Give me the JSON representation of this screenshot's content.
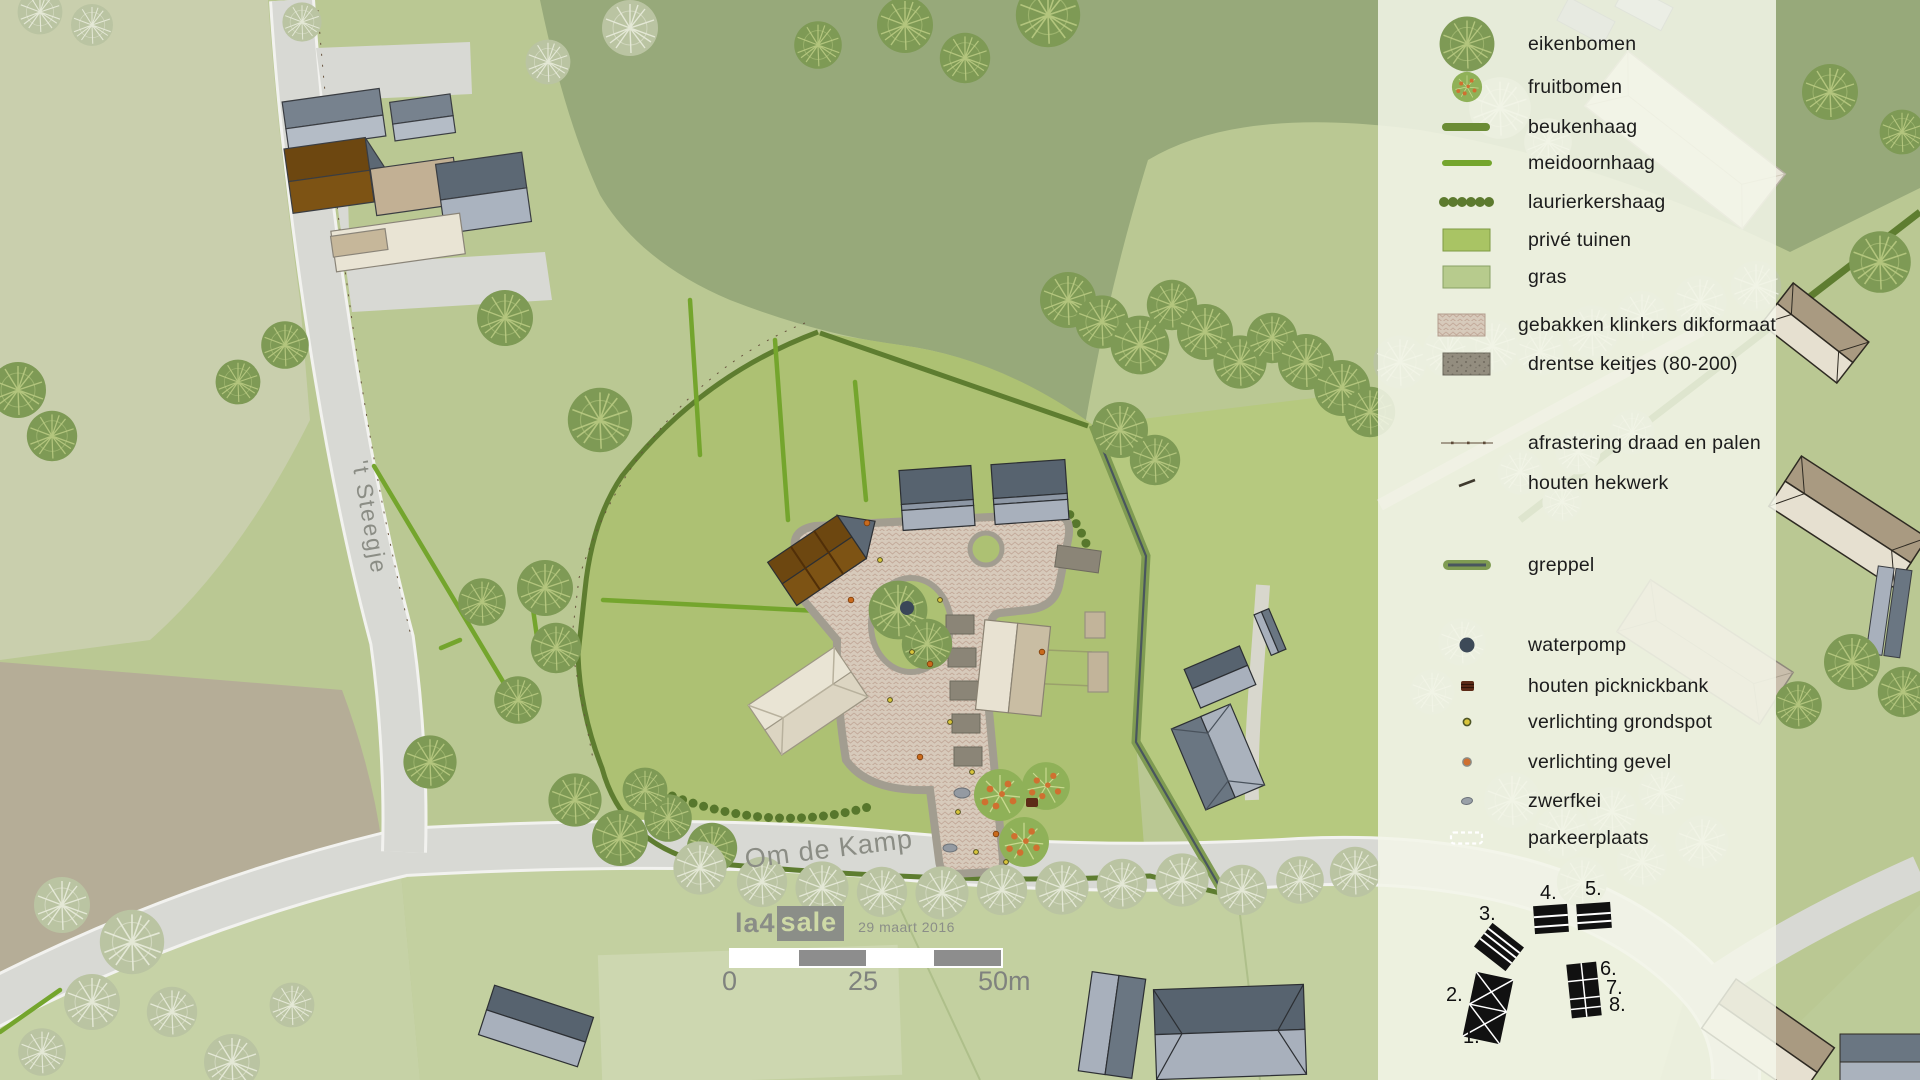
{
  "map": {
    "roads": {
      "vertical_road_label": "'t Steegje",
      "main_road_label": "Om de Kamp"
    },
    "scale_bar": {
      "tick_start": "0",
      "tick_mid": "25",
      "tick_end": "50m"
    },
    "credit": {
      "logo_prefix": "la4",
      "logo_suffix": "sale",
      "date": "29 maart 2016"
    }
  },
  "legend": {
    "items": [
      {
        "id": "eikenbomen",
        "label": "eikenbomen"
      },
      {
        "id": "fruitbomen",
        "label": "fruitbomen"
      },
      {
        "id": "beukenhaag",
        "label": "beukenhaag"
      },
      {
        "id": "meidoornhaag",
        "label": "meidoornhaag"
      },
      {
        "id": "laurierkershaag",
        "label": "laurierkershaag"
      },
      {
        "id": "prive-tuinen",
        "label": "privé tuinen"
      },
      {
        "id": "gras",
        "label": "gras"
      },
      {
        "id": "gebakken-klinkers",
        "label": "gebakken klinkers dikformaat"
      },
      {
        "id": "drentse-keitjes",
        "label": "drentse keitjes (80-200)"
      },
      {
        "id": "afrastering",
        "label": "afrastering draad en palen"
      },
      {
        "id": "houten-hekwerk",
        "label": "houten hekwerk"
      },
      {
        "id": "greppel",
        "label": "greppel"
      },
      {
        "id": "waterpomp",
        "label": "waterpomp"
      },
      {
        "id": "houten-picknickbank",
        "label": "houten picknickbank"
      },
      {
        "id": "verlichting-grondspot",
        "label": "verlichting grondspot"
      },
      {
        "id": "verlichting-gevel",
        "label": "verlichting gevel"
      },
      {
        "id": "zwerfkei",
        "label": "zwerfkei"
      },
      {
        "id": "parkeerplaats",
        "label": "parkeerplaats"
      }
    ],
    "key_numbers": [
      "1.",
      "2.",
      "3.",
      "4.",
      "5.",
      "6.",
      "7.",
      "8."
    ]
  },
  "colors": {
    "grass_base": "#bac893",
    "olive_field": "#97a97a",
    "site_green": "#adc173",
    "pale_field": "#c9cfad",
    "tan_field": "#b5ad97",
    "road_gray": "#d8d9d4",
    "brick": "#d7cabb",
    "keitjes": "#8b8577",
    "hedge_dark": "#5e7d30",
    "hedge_bright": "#74a52d",
    "slate_dark": "#57636f",
    "slate_light": "#a8b0bc",
    "roof_brown": "#6d4710",
    "cream_roof": "#e9e4d4",
    "legend_panel": "#f3f6e9",
    "fruit_orange": "#cf7030"
  }
}
